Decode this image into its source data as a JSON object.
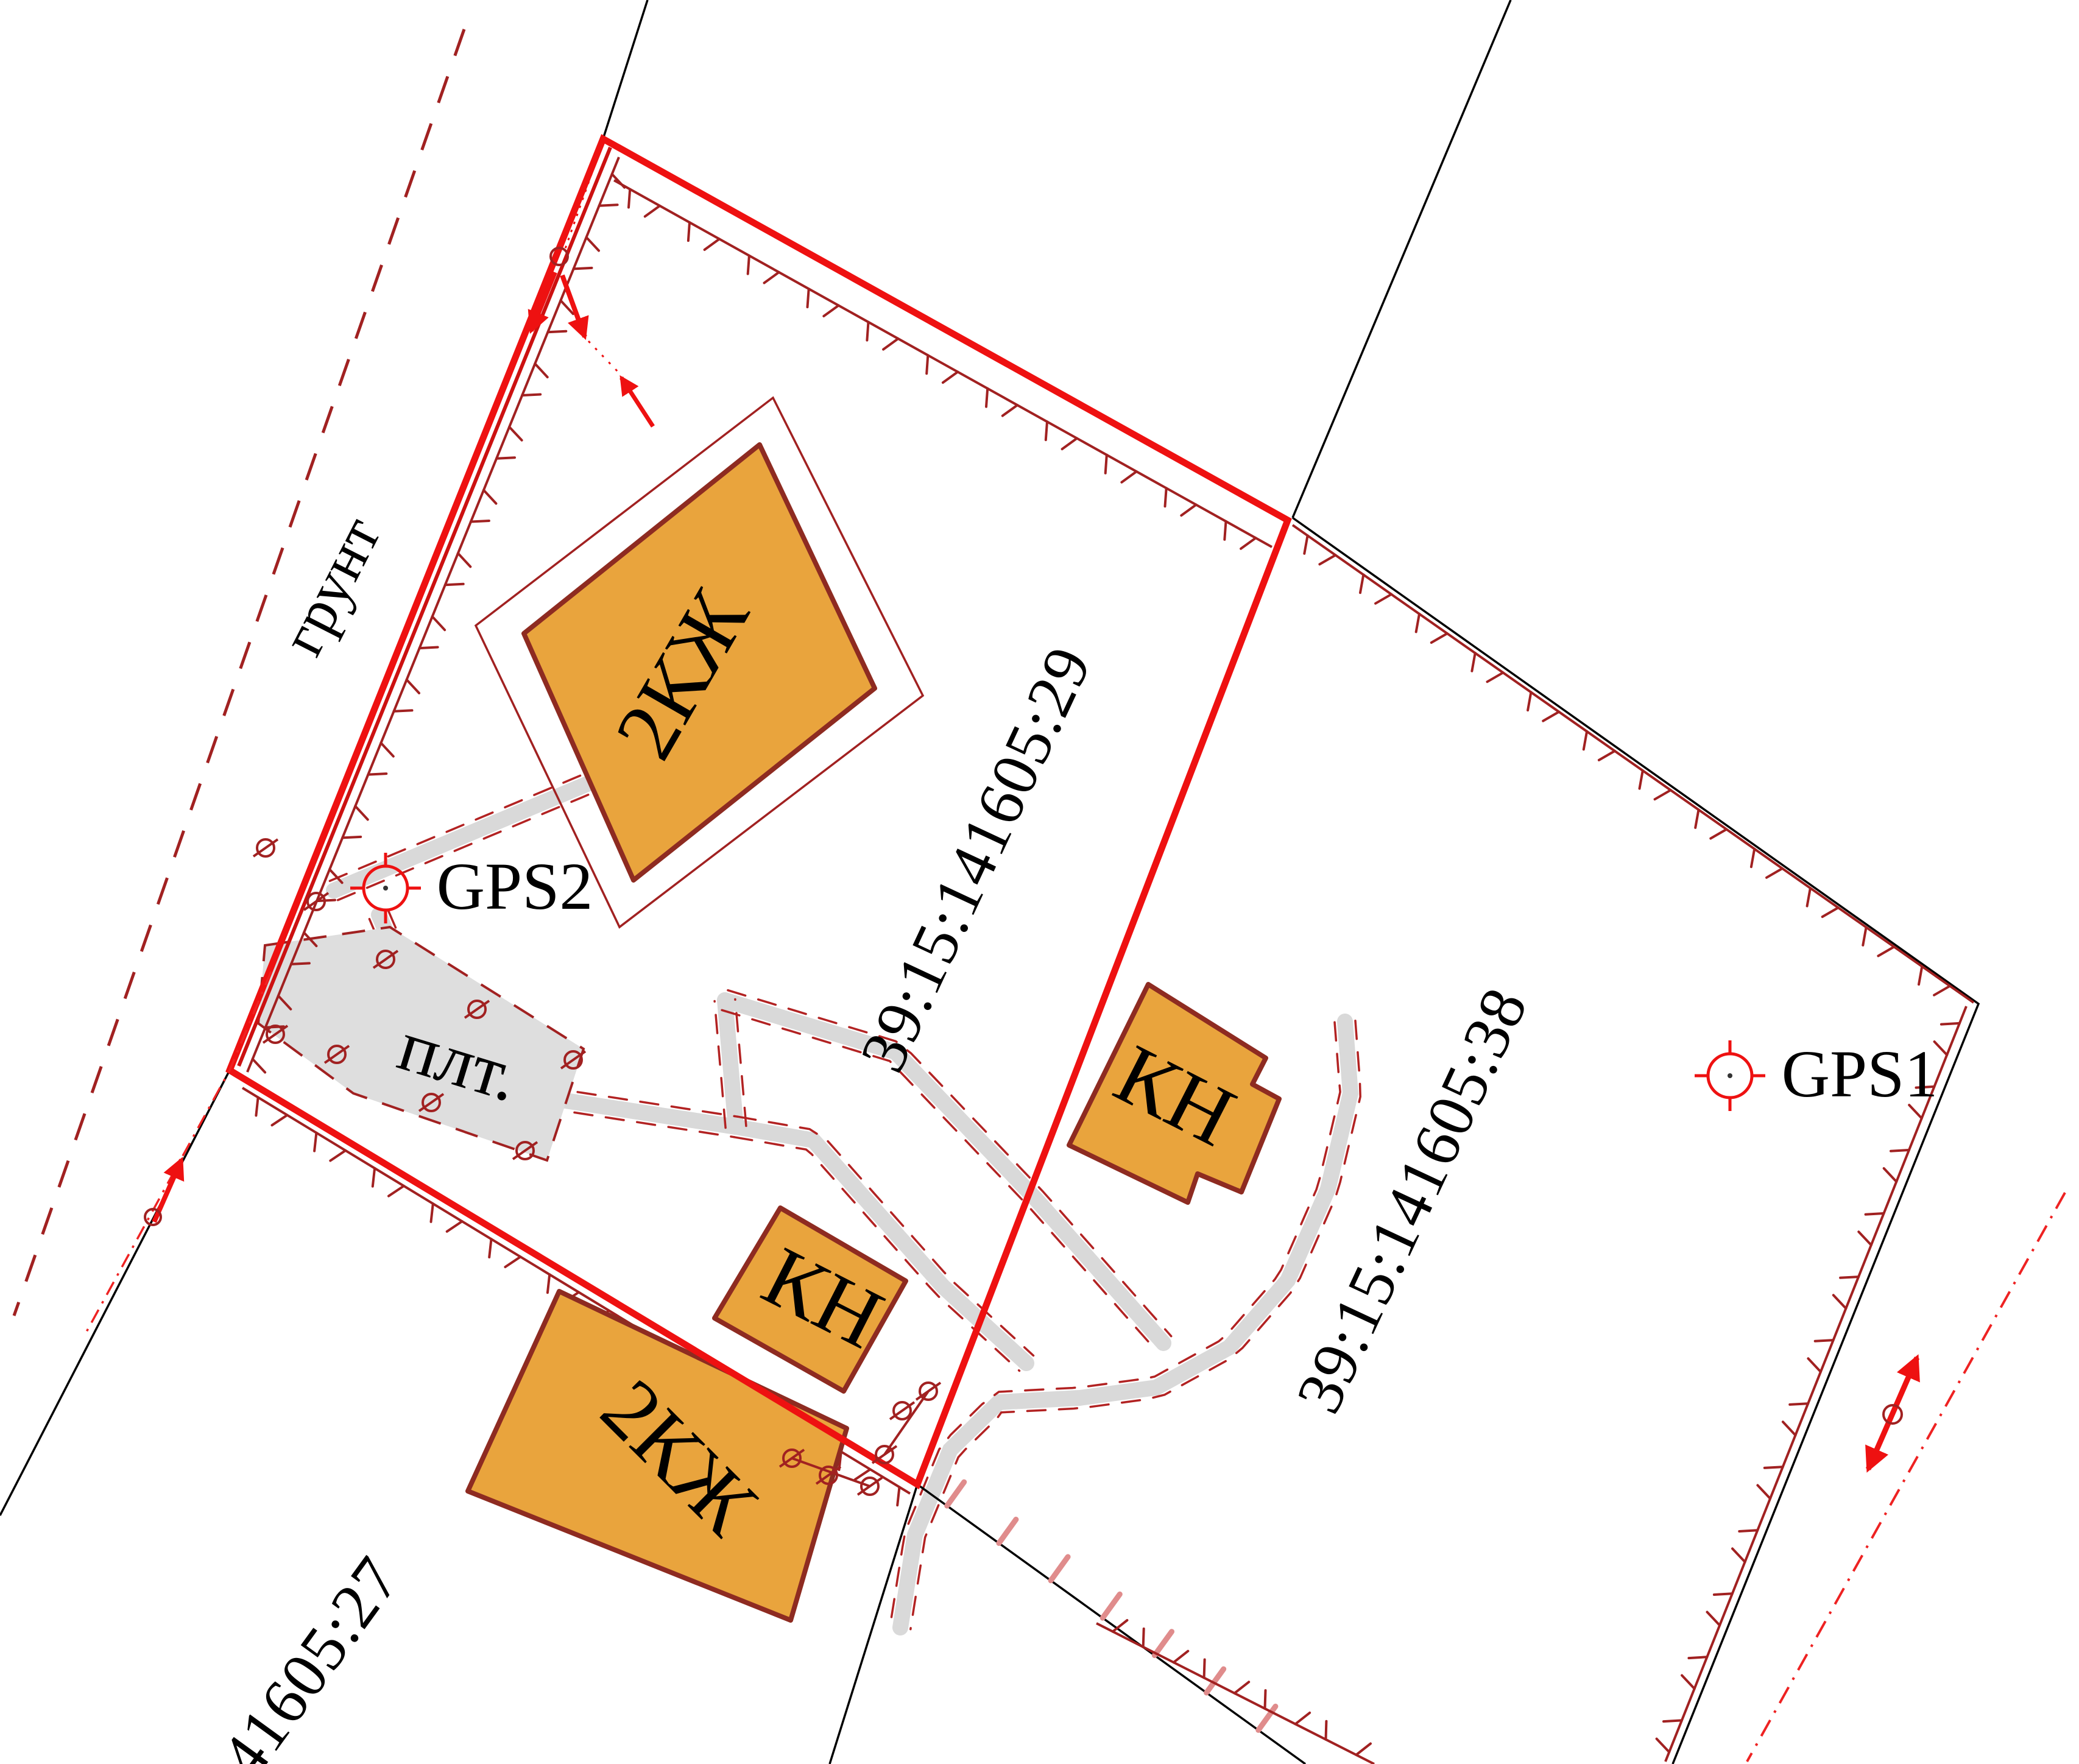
{
  "labels": {
    "ground": "грунт",
    "slab": "плт."
  },
  "gps": {
    "gps1": "GPS1",
    "gps2": "GPS2"
  },
  "parcels": {
    "p29": "39:15:141605:29",
    "p38": "39:15:141605:38",
    "p27": "41605:27"
  },
  "buildings": {
    "top_residential": "2КЖ",
    "mid_nonresidential": "КН",
    "bottom_nonresidential": "КН",
    "bottom_residential": "2КЖ"
  },
  "colors": {
    "boundary_new": "#ee1111",
    "boundary_secondary": "#cc1111",
    "boundary_cadastral": "#a12121",
    "quarter_line": "#000000",
    "building_fill": "#e9a43d",
    "building_outline": "#8e2b21",
    "path_fill": "#d9d9d9",
    "slab_fill": "#dedede",
    "pink_tick": "#e08c8c",
    "parcel29_label": "#ee1111"
  }
}
